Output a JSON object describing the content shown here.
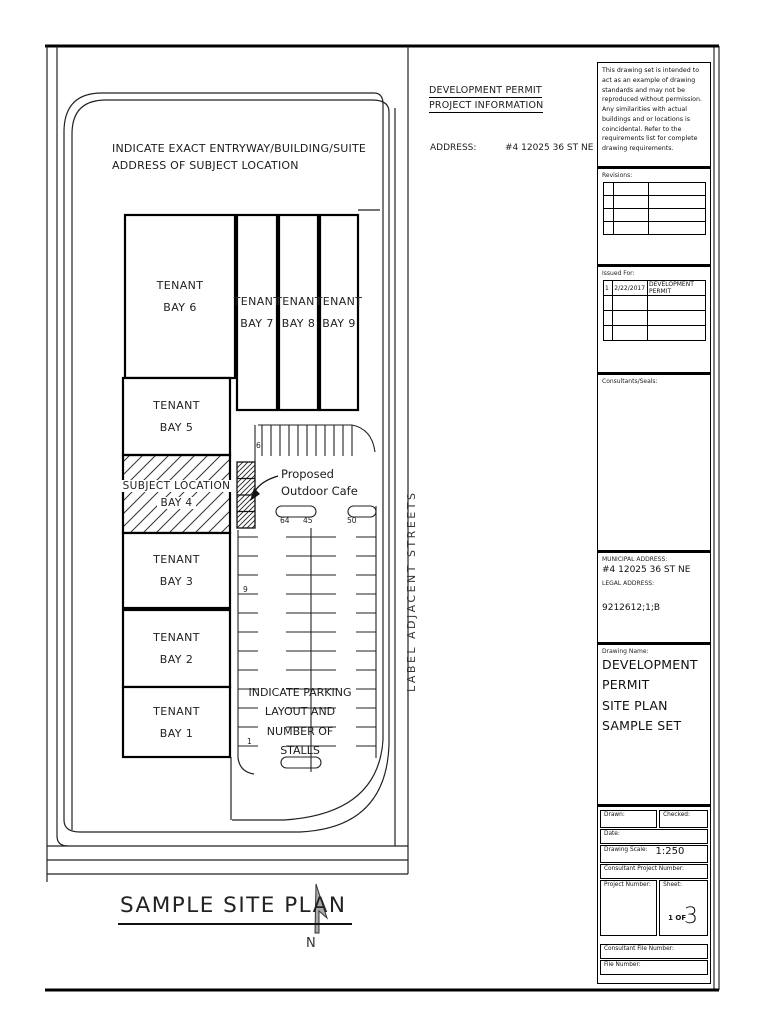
{
  "header": {
    "permit_line1": "DEVELOPMENT PERMIT",
    "permit_line2": "PROJECT INFORMATION",
    "address_label": "ADDRESS:",
    "address_value": "#4 12025 36 ST NE"
  },
  "plan": {
    "entry_note": "INDICATE EXACT ENTRYWAY/BUILDING/SUITE ADDRESS OF SUBJECT LOCATION",
    "street_label": "LABEL ADJACENT STREETS",
    "title": "SAMPLE SITE PLAN",
    "north": "N",
    "bays": [
      {
        "line1": "TENANT",
        "line2": "BAY 6"
      },
      {
        "line1": "TENANT",
        "line2": "BAY 7"
      },
      {
        "line1": "TENANT",
        "line2": "BAY 8"
      },
      {
        "line1": "TENANT",
        "line2": "BAY 9"
      },
      {
        "line1": "TENANT",
        "line2": "BAY 5"
      },
      {
        "line1": "SUBJECT LOCATION",
        "line2": "BAY 4"
      },
      {
        "line1": "TENANT",
        "line2": "BAY 3"
      },
      {
        "line1": "TENANT",
        "line2": "BAY 2"
      },
      {
        "line1": "TENANT",
        "line2": "BAY 1"
      }
    ],
    "cafe": {
      "line1": "Proposed",
      "line2": "Outdoor Cafe"
    },
    "parking_note": [
      "INDICATE PARKING",
      "LAYOUT AND",
      "NUMBER OF STALLS"
    ],
    "counts": {
      "top_row": "6",
      "center_left": "64",
      "center_right": "45",
      "right_row": "50",
      "left_upper": "9",
      "left_lower": "1"
    }
  },
  "titleblock": {
    "disclaimer": "This drawing set is intended to act as an example of drawing standards and may not be reproduced without permission. Any similarities with actual buildings and or locations is coincidental. Refer to the requirements list for complete drawing requirements.",
    "revisions_label": "Revisions:",
    "issued_for_label": "Issued For:",
    "issued_rows": [
      {
        "num": "1",
        "date": "2/22/2017",
        "desc": "DEVELOPMENT PERMIT"
      }
    ],
    "consultants_label": "Consultants/Seals:",
    "municipal_label": "MUNICIPAL ADDRESS:",
    "municipal_value": "#4 12025 36 ST NE",
    "legal_label": "LEGAL ADDRESS:",
    "legal_value": "9212612;1;B",
    "drawing_name_label": "Drawing Name:",
    "drawing_name_lines": [
      "DEVELOPMENT PERMIT",
      "SITE PLAN",
      "SAMPLE SET"
    ],
    "fields": {
      "drawn": "Drawn:",
      "checked": "Checked:",
      "date": "Date:",
      "scale_label": "Drawing Scale:",
      "scale_value": "1:250",
      "consultant_project": "Consultant Project Number:",
      "project": "Project Number:",
      "sheet_label": "Sheet:",
      "sheet_of": "1 OF",
      "sheet_num": "3",
      "consultant_file": "Consultant File Number:",
      "file": "File Number:"
    }
  }
}
